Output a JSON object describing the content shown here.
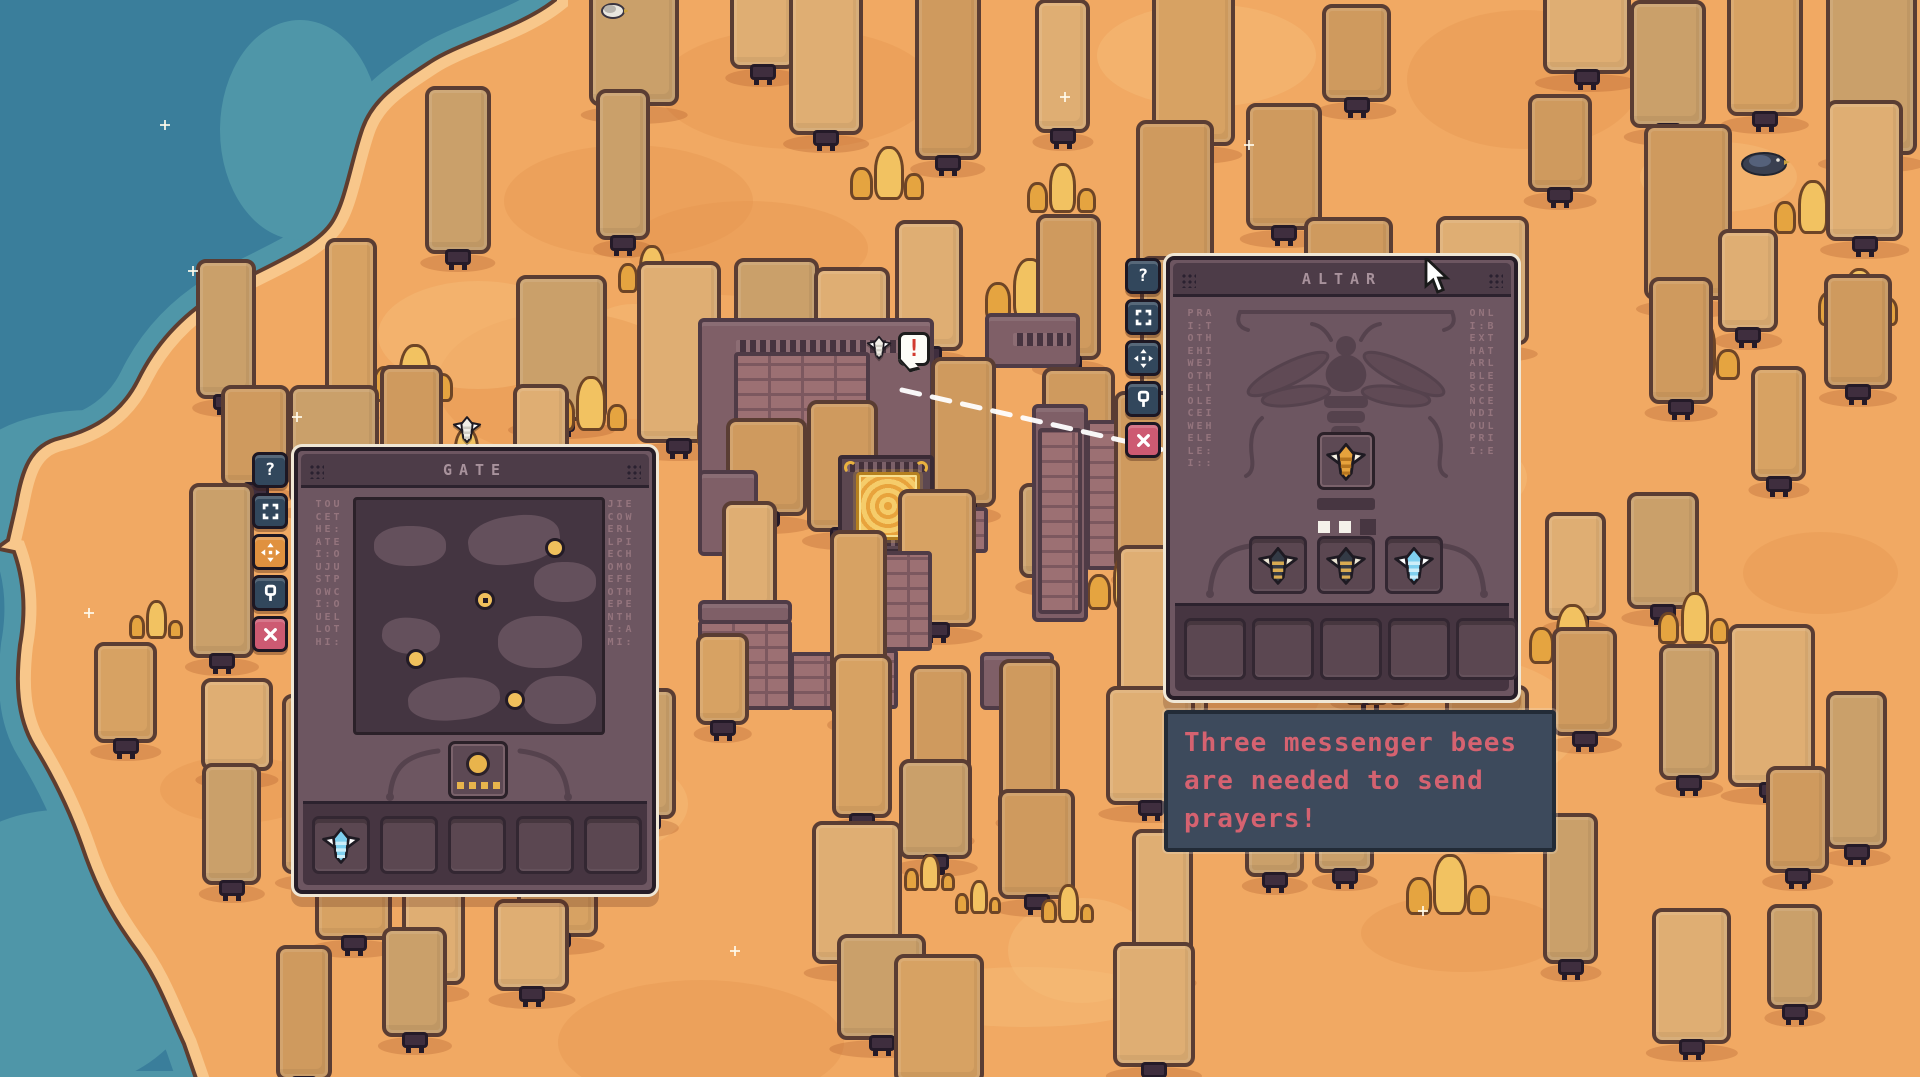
{
  "panels": {
    "gate": {
      "title": "GATE",
      "side_buttons": [
        {
          "name": "help",
          "glyph": "?",
          "style": "navy"
        },
        {
          "name": "frame",
          "glyph": "",
          "style": "navy"
        },
        {
          "name": "move",
          "glyph": "",
          "style": "orange"
        },
        {
          "name": "pin",
          "glyph": "",
          "style": "navy"
        },
        {
          "name": "close",
          "glyph": "",
          "style": "pink"
        }
      ],
      "rune_left": "TOU\nCET\nHE:\nATE\nI:O\nUJU\nSTP\nOWC\nI:O\nUEL\nLOT\nHI:",
      "rune_right": "JIE\nCOW\nERL\nLPI\nECH\nOMO\nEFE\nOTH\nEPE\nNTH\nI:A\nMI:",
      "map_dots": [
        {
          "x": 0.79,
          "y": 0.2,
          "ring": false
        },
        {
          "x": 0.51,
          "y": 0.42,
          "ring": true
        },
        {
          "x": 0.24,
          "y": 0.67,
          "ring": false
        },
        {
          "x": 0.63,
          "y": 0.84,
          "ring": false
        }
      ],
      "counter": {
        "big_dot": 1,
        "small_squares": 4
      },
      "inventory": [
        "ghost-bee",
        "",
        "",
        "",
        ""
      ]
    },
    "altar": {
      "title": "ALTAR",
      "side_buttons": [
        {
          "name": "help",
          "glyph": "?",
          "style": "navy"
        },
        {
          "name": "frame",
          "glyph": "",
          "style": "navy"
        },
        {
          "name": "move",
          "glyph": "",
          "style": "navy"
        },
        {
          "name": "pin",
          "glyph": "",
          "style": "navy"
        },
        {
          "name": "close",
          "glyph": "",
          "style": "pink"
        }
      ],
      "rune_left": "PRA\nI:T\nOTH\nEHI\nWEJ\nOTH\nELT\nOLE\nCEI\nWEH\nELE\nLE:\nI::",
      "rune_right": "ONL\nI:B\nEXT\nHAT\nARL\nBLE\nSCE\nNCE\nNDI\nOUL\nPRI\nI:E",
      "offering_slot": "offer-bee",
      "progress": {
        "filled": 2,
        "total": 3
      },
      "bee_slots": [
        "worker-bee",
        "worker-bee",
        "ghost-bee"
      ],
      "inventory": [
        "",
        "",
        "",
        "",
        ""
      ]
    }
  },
  "tooltip": {
    "lines": [
      "Three messenger bees",
      "are needed to send",
      "prayers!"
    ]
  },
  "world": {
    "alert_glyph": "!"
  },
  "colors": {
    "sand": "#f1a963",
    "sand_dark": "#e5964e",
    "sand_light": "#f6bb77",
    "water_deep": "#3a7e9b",
    "water_light": "#4f96a8",
    "shore": "#f8c78b",
    "shore_line": "#5f3d2f",
    "slab_tones": [
      "#d7a263",
      "#cf9a5e",
      "#dfae73",
      "#caa06a"
    ],
    "crystal": "#f2c261",
    "crystal_dark": "#e5a440",
    "panel_bg": "#6d5661",
    "panel_dark": "#4d3c48",
    "engraving": "#55424d",
    "btn_navy": "#32475c",
    "btn_orange": "#e0913f",
    "btn_pink": "#cd5a72",
    "gold": "#eebc53",
    "tooltip_text": "#d56270",
    "bee_worker_body": "#333a45",
    "bee_wing": "#ece6d4",
    "bee_stripe": "#d8ab52",
    "bee_ghost_body": "#7fd0ef",
    "bee_offer_body": "#e6a23c",
    "bee_marker_body": "#f2efe8"
  }
}
